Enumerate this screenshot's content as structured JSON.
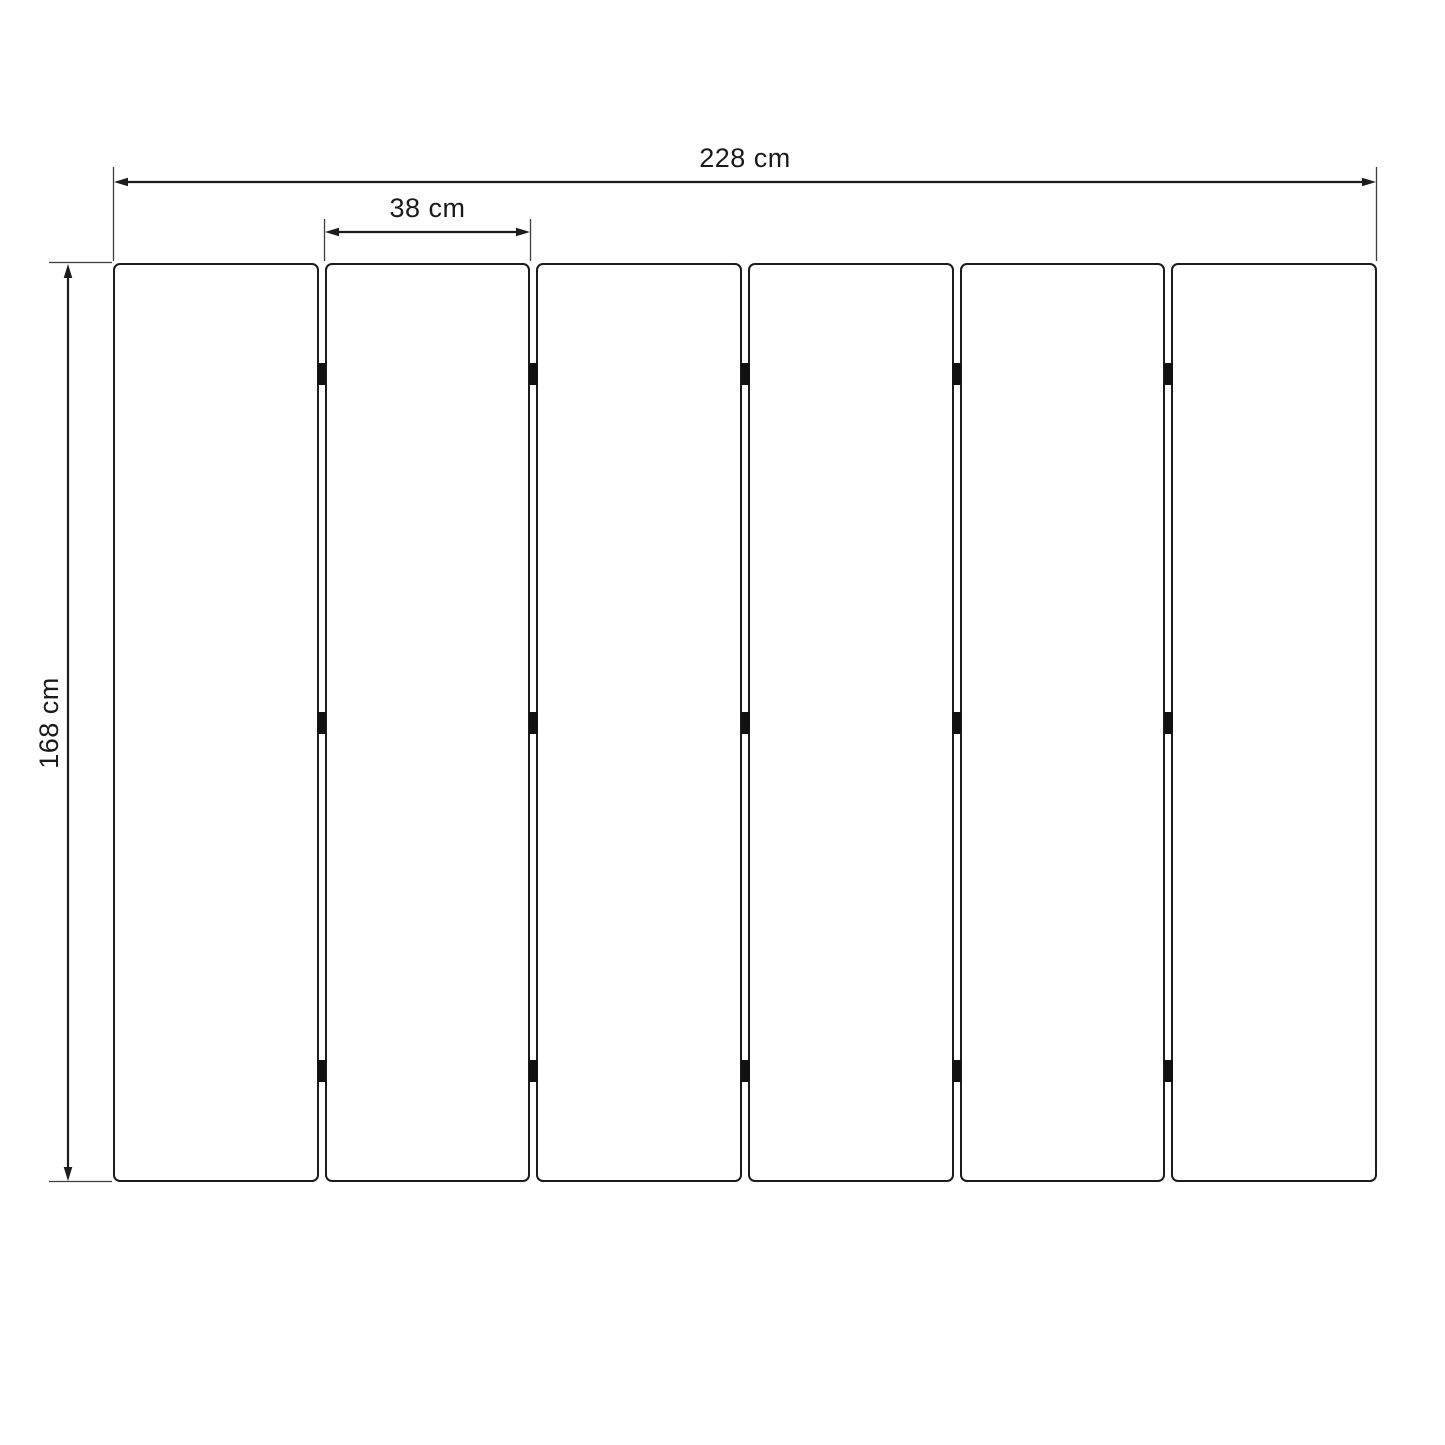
{
  "diagram": {
    "description": "Technical dimension drawing of a six-panel folding screen / slatted surface viewed from the front",
    "panel_count": 6,
    "connectors_per_gap": 3,
    "connector_row_fractions": [
      0.121,
      0.5,
      0.879
    ],
    "total_width_cm": 228,
    "panel_width_cm": 38,
    "height_cm": 168
  },
  "dimensions": {
    "total_width_label": "228 cm",
    "panel_width_label": "38 cm",
    "height_label": "168 cm"
  },
  "colors": {
    "line": "#1c1c1c",
    "extension_line": "#3f3f3f",
    "text": "#1a1a1a",
    "panel_fill": "#ffffff",
    "connector": "#111111",
    "background": "#ffffff"
  }
}
